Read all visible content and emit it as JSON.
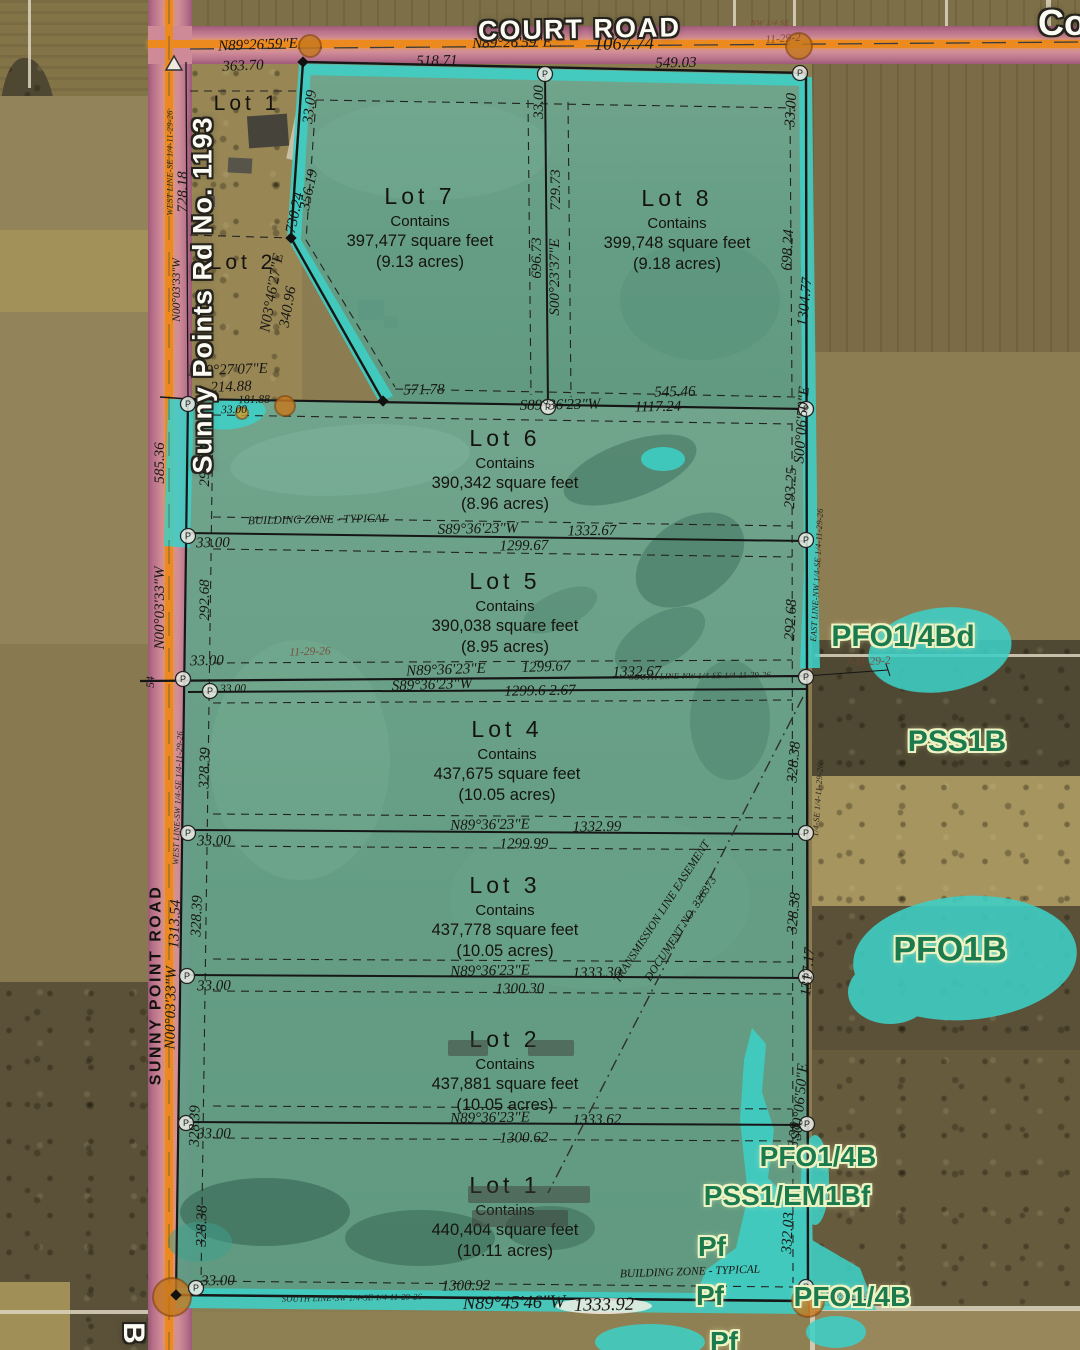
{
  "map_titles": {
    "court_road": "COURT ROAD",
    "corner_co": "Co",
    "sunny_sign": "Sunny Points Rd No. 1193",
    "edge_letter": "B"
  },
  "lots_excluded": [
    {
      "label": "Lot 1",
      "x": 247,
      "y": 104
    },
    {
      "label": "Lot 2",
      "x": 243,
      "y": 263
    }
  ],
  "lots": [
    {
      "label": "Lot 7",
      "contains": "Contains",
      "sqft": "397,477 square feet",
      "acres": "(9.13 acres)",
      "x": 420,
      "y": 183
    },
    {
      "label": "Lot 8",
      "contains": "Contains",
      "sqft": "399,748 square feet",
      "acres": "(9.18 acres)",
      "x": 677,
      "y": 185
    },
    {
      "label": "Lot 6",
      "contains": "Contains",
      "sqft": "390,342 square feet",
      "acres": "(8.96 acres)",
      "x": 505,
      "y": 425
    },
    {
      "label": "Lot 5",
      "contains": "Contains",
      "sqft": "390,038 square feet",
      "acres": "(8.95 acres)",
      "x": 505,
      "y": 568
    },
    {
      "label": "Lot 4",
      "contains": "Contains",
      "sqft": "437,675 square feet",
      "acres": "(10.05 acres)",
      "x": 507,
      "y": 716
    },
    {
      "label": "Lot 3",
      "contains": "Contains",
      "sqft": "437,778 square feet",
      "acres": "(10.05 acres)",
      "x": 505,
      "y": 872
    },
    {
      "label": "Lot 2",
      "contains": "Contains",
      "sqft": "437,881 square feet",
      "acres": "(10.05 acres)",
      "x": 505,
      "y": 1026
    },
    {
      "label": "Lot 1",
      "contains": "Contains",
      "sqft": "440,404 square feet",
      "acres": "(10.11 acres)",
      "x": 505,
      "y": 1172
    }
  ],
  "wetland_labels": [
    {
      "t": "PFO1/4Bd",
      "x": 903,
      "y": 637,
      "s": 30
    },
    {
      "t": "PSS1B",
      "x": 957,
      "y": 742,
      "s": 30
    },
    {
      "t": "PFO1B",
      "x": 950,
      "y": 950,
      "s": 34
    },
    {
      "t": "PFO1/4B",
      "x": 818,
      "y": 1157,
      "s": 28
    },
    {
      "t": "PSS1/EM1Bf",
      "x": 787,
      "y": 1196,
      "s": 28
    },
    {
      "t": "Pf",
      "x": 712,
      "y": 1247,
      "s": 28
    },
    {
      "t": "Pf",
      "x": 710,
      "y": 1296,
      "s": 28
    },
    {
      "t": "PFO1/4B",
      "x": 852,
      "y": 1297,
      "s": 28
    },
    {
      "t": "Pf",
      "x": 724,
      "y": 1342,
      "s": 28
    }
  ],
  "survey_labels": [
    {
      "t": "N89°26'59\"E",
      "x": 258,
      "y": 46,
      "r": -2
    },
    {
      "t": "363.70",
      "x": 243,
      "y": 67,
      "r": -2
    },
    {
      "t": "N89°26'59\"E",
      "x": 512,
      "y": 44,
      "r": -1
    },
    {
      "t": "1067.74",
      "x": 624,
      "y": 45,
      "r": -1,
      "c": "l"
    },
    {
      "t": "518.71",
      "x": 437,
      "y": 62,
      "r": -1
    },
    {
      "t": "549.03",
      "x": 676,
      "y": 64,
      "r": -1
    },
    {
      "t": "NW 1/4 SE",
      "x": 770,
      "y": 23,
      "r": 0,
      "c": "t f"
    },
    {
      "t": "11-29-2",
      "x": 783,
      "y": 39,
      "r": -4,
      "c": "s f"
    },
    {
      "t": "33.09",
      "x": 311,
      "y": 107,
      "r": -83
    },
    {
      "t": "33.00",
      "x": 540,
      "y": 102,
      "r": -90
    },
    {
      "t": "33.00",
      "x": 792,
      "y": 110,
      "r": -87
    },
    {
      "t": "WEST LINE-SE 1/4-11-29-26",
      "x": 170,
      "y": 163,
      "r": -90,
      "c": "t"
    },
    {
      "t": "728.18",
      "x": 184,
      "y": 192,
      "r": -90
    },
    {
      "t": "N00°03'33\"W",
      "x": 177,
      "y": 290,
      "r": -90,
      "c": "s"
    },
    {
      "t": "730.24",
      "x": 296,
      "y": 213,
      "r": -78
    },
    {
      "t": "356.19",
      "x": 310,
      "y": 190,
      "r": -78
    },
    {
      "t": "729.73",
      "x": 557,
      "y": 190,
      "r": -90
    },
    {
      "t": "696.73",
      "x": 538,
      "y": 258,
      "r": -90
    },
    {
      "t": "S00°23'37\"E",
      "x": 556,
      "y": 277,
      "r": -90
    },
    {
      "t": "698.24",
      "x": 789,
      "y": 250,
      "r": -87
    },
    {
      "t": "1304.77",
      "x": 806,
      "y": 302,
      "r": -84
    },
    {
      "t": "N03°46'27\"E",
      "x": 273,
      "y": 293,
      "r": -80
    },
    {
      "t": "340.96",
      "x": 289,
      "y": 307,
      "r": -80
    },
    {
      "t": "N89°27'07\"E",
      "x": 228,
      "y": 371,
      "r": -2
    },
    {
      "t": "214.88",
      "x": 231,
      "y": 388,
      "r": -2
    },
    {
      "t": "181.88",
      "x": 254,
      "y": 400,
      "r": -1,
      "c": "s"
    },
    {
      "t": "33.00",
      "x": 234,
      "y": 410,
      "r": -1,
      "c": "s"
    },
    {
      "t": "571.78",
      "x": 424,
      "y": 391,
      "r": -1
    },
    {
      "t": "545.46",
      "x": 675,
      "y": 393,
      "r": -1
    },
    {
      "t": "S89°36'23\"W",
      "x": 560,
      "y": 406,
      "r": -1
    },
    {
      "t": "1117.24",
      "x": 658,
      "y": 408,
      "r": -1
    },
    {
      "t": "585.36",
      "x": 161,
      "y": 463,
      "r": -90
    },
    {
      "t": "292.68",
      "x": 206,
      "y": 466,
      "r": -90
    },
    {
      "t": "S00°06'50\"E",
      "x": 803,
      "y": 425,
      "r": -86
    },
    {
      "t": "293.25",
      "x": 792,
      "y": 488,
      "r": -87
    },
    {
      "t": "EAST LINE-NW 1/4-SE 1/4-11-29-26",
      "x": 817,
      "y": 575,
      "r": -87,
      "c": "t"
    },
    {
      "t": "292.68",
      "x": 792,
      "y": 620,
      "r": -87
    },
    {
      "t": "BUILDING ZONE  -  TYPICAL",
      "x": 318,
      "y": 520,
      "r": -1,
      "c": "s"
    },
    {
      "t": "S89°36'23\"W",
      "x": 478,
      "y": 530,
      "r": -1
    },
    {
      "t": "1332.67",
      "x": 592,
      "y": 532,
      "r": -1
    },
    {
      "t": "33.00",
      "x": 213,
      "y": 544,
      "r": -1
    },
    {
      "t": "1299.67",
      "x": 524,
      "y": 547,
      "r": -1
    },
    {
      "t": "292.68",
      "x": 206,
      "y": 600,
      "r": -90
    },
    {
      "t": "N00°03'33\"W",
      "x": 161,
      "y": 608,
      "r": -90
    },
    {
      "t": "33.00",
      "x": 207,
      "y": 662,
      "r": -1
    },
    {
      "t": "11-29-26",
      "x": 310,
      "y": 652,
      "r": -2,
      "c": "s f"
    },
    {
      "t": "N89°36'23\"E",
      "x": 446,
      "y": 671,
      "r": -2
    },
    {
      "t": "1299.67",
      "x": 546,
      "y": 668,
      "r": -2
    },
    {
      "t": "1332.67",
      "x": 637,
      "y": 673,
      "r": -1
    },
    {
      "t": "SOUTH LINE-NW 1/4-SE 1/4-11-29-26",
      "x": 700,
      "y": 676,
      "r": -1,
      "c": "t"
    },
    {
      "t": "S89°36'23\"W",
      "x": 432,
      "y": 686,
      "r": -2
    },
    {
      "t": "1299.6 2.67",
      "x": 540,
      "y": 692,
      "r": -1
    },
    {
      "t": "7-11-29-2",
      "x": 868,
      "y": 662,
      "r": -3,
      "c": "s f"
    },
    {
      "t": "33.00",
      "x": 233,
      "y": 689,
      "r": -1,
      "c": "s"
    },
    {
      "t": "54",
      "x": 151,
      "y": 682,
      "r": -90,
      "c": "s"
    },
    {
      "t": "WEST LINE-SW 1/4-SE 1/4-11-29-26",
      "x": 178,
      "y": 798,
      "r": -88,
      "c": "t"
    },
    {
      "t": "328.39",
      "x": 206,
      "y": 768,
      "r": -88
    },
    {
      "t": "328.38",
      "x": 795,
      "y": 762,
      "r": -85
    },
    {
      "t": "1/4-SE 1/4-11-29-26",
      "x": 818,
      "y": 800,
      "r": -86,
      "c": "t"
    },
    {
      "t": "N89°36'23\"E",
      "x": 490,
      "y": 826,
      "r": -1
    },
    {
      "t": "1332.99",
      "x": 597,
      "y": 828,
      "r": -1
    },
    {
      "t": "33.00",
      "x": 214,
      "y": 842,
      "r": -1
    },
    {
      "t": "1299.99",
      "x": 524,
      "y": 845,
      "r": -1
    },
    {
      "t": "1313.54",
      "x": 176,
      "y": 924,
      "r": -88
    },
    {
      "t": "328.39",
      "x": 198,
      "y": 916,
      "r": -88
    },
    {
      "t": "328.38",
      "x": 795,
      "y": 913,
      "r": -85
    },
    {
      "t": "1317.17",
      "x": 809,
      "y": 972,
      "r": -85
    },
    {
      "t": "TRANSMISSION LINE EASEMENT",
      "x": 662,
      "y": 912,
      "r": -57,
      "c": "s"
    },
    {
      "t": "DOCUMENT NO. 326373",
      "x": 681,
      "y": 929,
      "r": -57,
      "c": "s"
    },
    {
      "t": "N89°36'23\"E",
      "x": 490,
      "y": 972,
      "r": -1
    },
    {
      "t": "1333.30",
      "x": 597,
      "y": 974,
      "r": -1
    },
    {
      "t": "33.00",
      "x": 214,
      "y": 987,
      "r": -1
    },
    {
      "t": "1300.30",
      "x": 520,
      "y": 990,
      "r": -1
    },
    {
      "t": "SUNNY POINT ROAD",
      "x": 157,
      "y": 985,
      "r": -90,
      "c": "rd"
    },
    {
      "t": "N00°03'33\"W",
      "x": 172,
      "y": 1008,
      "r": -89
    },
    {
      "t": "328.39",
      "x": 196,
      "y": 1126,
      "r": -89
    },
    {
      "t": "S00°06'50\"E",
      "x": 801,
      "y": 1102,
      "r": -85
    },
    {
      "t": "328.38",
      "x": 795,
      "y": 1143,
      "r": -85
    },
    {
      "t": "N89°36'23\"E",
      "x": 490,
      "y": 1119,
      "r": -1
    },
    {
      "t": "1333.62",
      "x": 597,
      "y": 1121,
      "r": -1
    },
    {
      "t": "33.00",
      "x": 214,
      "y": 1135,
      "r": -1
    },
    {
      "t": "1300.62",
      "x": 524,
      "y": 1139,
      "r": -1
    },
    {
      "t": "328.38",
      "x": 203,
      "y": 1226,
      "r": -89
    },
    {
      "t": "332.03",
      "x": 789,
      "y": 1233,
      "r": -87
    },
    {
      "t": "BUILDING ZONE  -  TYPICAL",
      "x": 690,
      "y": 1272,
      "r": -2,
      "c": "s"
    },
    {
      "t": "33.00",
      "x": 218,
      "y": 1282,
      "r": -1
    },
    {
      "t": "1300.92",
      "x": 466,
      "y": 1287,
      "r": -1
    },
    {
      "t": "SOUTH LINE-SW 1/4-SE 1/4-11-29-26",
      "x": 352,
      "y": 1298,
      "r": -1,
      "c": "t"
    },
    {
      "t": "N89°45'46\"W",
      "x": 514,
      "y": 1304,
      "r": -1,
      "c": "l"
    },
    {
      "t": "1333.92",
      "x": 604,
      "y": 1306,
      "r": -1,
      "c": "l"
    },
    {
      "t": "N89°45'46",
      "x": 850,
      "y": 1296,
      "r": -2,
      "c": "s f"
    }
  ]
}
